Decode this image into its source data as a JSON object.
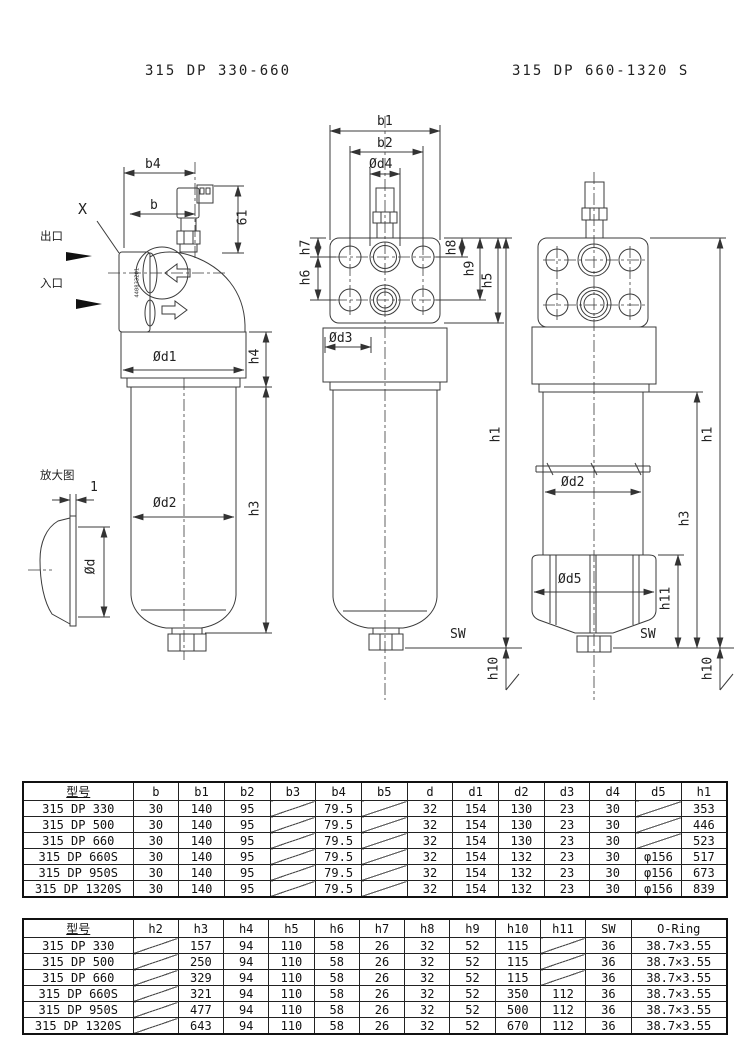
{
  "titles": {
    "left": "315 DP 330-660",
    "right": "315 DP 660-1320 S"
  },
  "drawings": {
    "left": {
      "b4": "b4",
      "b": "b",
      "x_mark": "X",
      "outlet": "出口",
      "inlet": "入口",
      "d61": "61",
      "od1": "Ød1",
      "h4": "h4",
      "od2": "Ød2",
      "h3": "h3",
      "enlarged_view": "放大图",
      "d1": "1",
      "od": "Ød",
      "part_no": "440833201"
    },
    "middle": {
      "b1": "b1",
      "b2": "b2",
      "od4": "Ød4",
      "h7": "h7",
      "h6": "h6",
      "h8": "h8",
      "h9": "h9",
      "h5": "h5",
      "od3": "Ød3",
      "h1": "h1",
      "sw": "SW",
      "h10": "h10"
    },
    "right": {
      "od2": "Ød2",
      "od5": "Ød5",
      "h11": "h11",
      "sw": "SW",
      "h3": "h3",
      "h1": "h1",
      "h10": "h10"
    }
  },
  "tables": {
    "dimensions1": {
      "headers": [
        "型号",
        "b",
        "b1",
        "b2",
        "b3",
        "b4",
        "b5",
        "d",
        "d1",
        "d2",
        "d3",
        "d4",
        "d5",
        "h1"
      ],
      "rows": [
        [
          "315 DP 330",
          "30",
          "140",
          "95",
          null,
          "79.5",
          null,
          "32",
          "154",
          "130",
          "23",
          "30",
          null,
          "353"
        ],
        [
          "315 DP 500",
          "30",
          "140",
          "95",
          null,
          "79.5",
          null,
          "32",
          "154",
          "130",
          "23",
          "30",
          null,
          "446"
        ],
        [
          "315 DP 660",
          "30",
          "140",
          "95",
          null,
          "79.5",
          null,
          "32",
          "154",
          "130",
          "23",
          "30",
          null,
          "523"
        ],
        [
          "315 DP 660S",
          "30",
          "140",
          "95",
          null,
          "79.5",
          null,
          "32",
          "154",
          "132",
          "23",
          "30",
          "φ156",
          "517"
        ],
        [
          "315 DP 950S",
          "30",
          "140",
          "95",
          null,
          "79.5",
          null,
          "32",
          "154",
          "132",
          "23",
          "30",
          "φ156",
          "673"
        ],
        [
          "315 DP 1320S",
          "30",
          "140",
          "95",
          null,
          "79.5",
          null,
          "32",
          "154",
          "132",
          "23",
          "30",
          "φ156",
          "839"
        ]
      ]
    },
    "dimensions2": {
      "headers": [
        "型号",
        "h2",
        "h3",
        "h4",
        "h5",
        "h6",
        "h7",
        "h8",
        "h9",
        "h10",
        "h11",
        "SW",
        "O-Ring"
      ],
      "rows": [
        [
          "315 DP 330",
          null,
          "157",
          "94",
          "110",
          "58",
          "26",
          "32",
          "52",
          "115",
          null,
          "36",
          "38.7×3.55"
        ],
        [
          "315 DP 500",
          null,
          "250",
          "94",
          "110",
          "58",
          "26",
          "32",
          "52",
          "115",
          null,
          "36",
          "38.7×3.55"
        ],
        [
          "315 DP 660",
          null,
          "329",
          "94",
          "110",
          "58",
          "26",
          "32",
          "52",
          "115",
          null,
          "36",
          "38.7×3.55"
        ],
        [
          "315 DP 660S",
          null,
          "321",
          "94",
          "110",
          "58",
          "26",
          "32",
          "52",
          "350",
          "112",
          "36",
          "38.7×3.55"
        ],
        [
          "315 DP 950S",
          null,
          "477",
          "94",
          "110",
          "58",
          "26",
          "32",
          "52",
          "500",
          "112",
          "36",
          "38.7×3.55"
        ],
        [
          "315 DP 1320S",
          null,
          "643",
          "94",
          "110",
          "58",
          "26",
          "32",
          "52",
          "670",
          "112",
          "36",
          "38.7×3.55"
        ]
      ]
    }
  }
}
